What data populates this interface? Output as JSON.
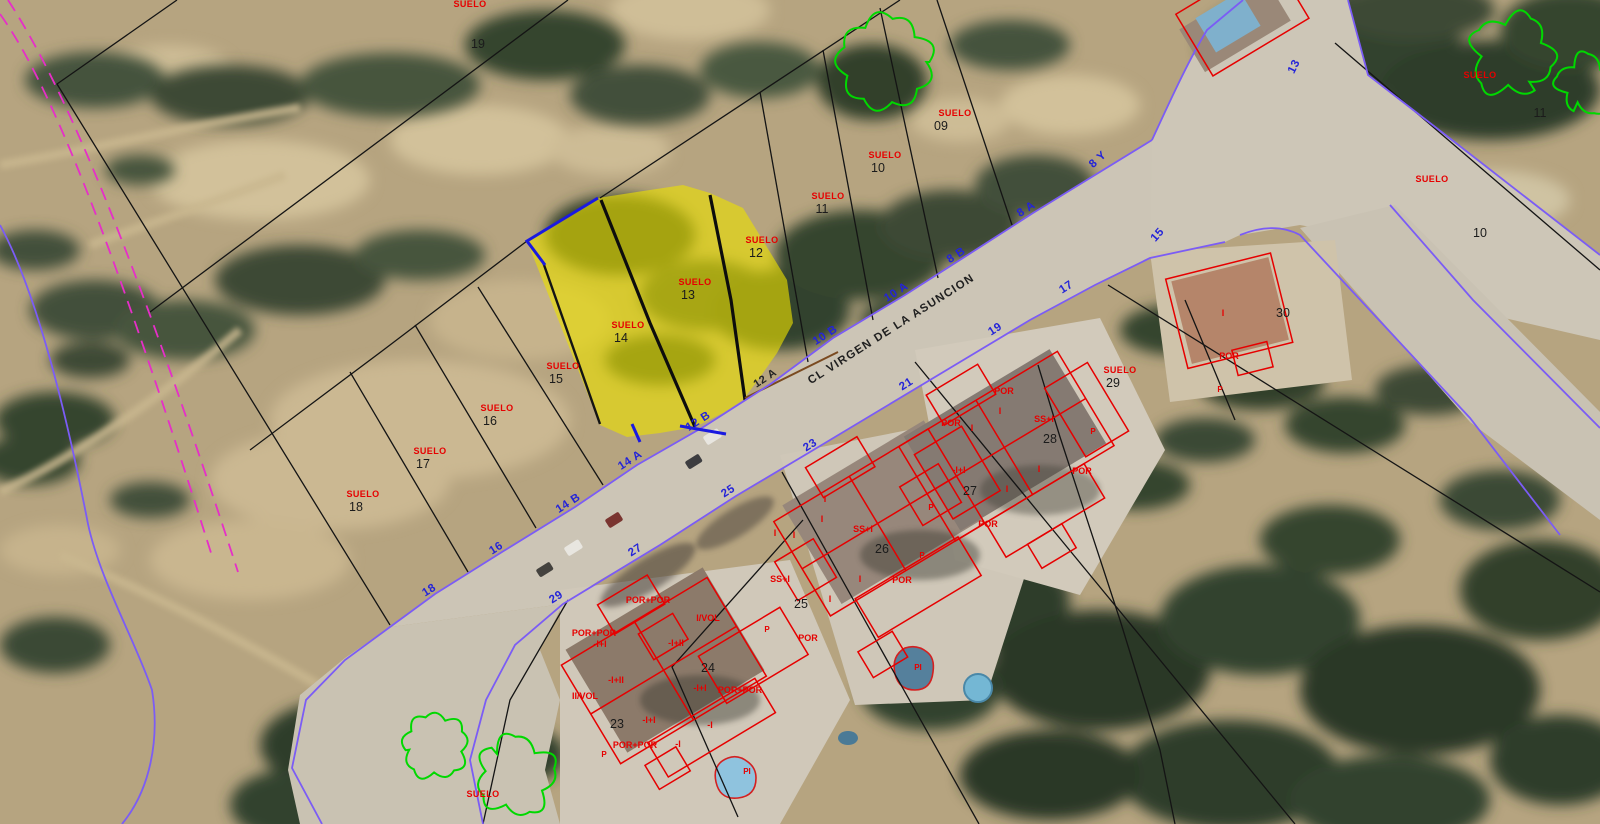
{
  "map": {
    "title": "Cadastral parcel map over aerial photo",
    "street_name": "CL VIRGEN DE LA ASUNCION",
    "selected_parcel": {
      "label": "SUELO",
      "numbers": [
        "13",
        "14"
      ],
      "frontages": [
        "12 A",
        "12 B"
      ]
    },
    "colors": {
      "parcel_line": "#141414",
      "street_line": "#7b5cf5",
      "selected_outline": "#1a1ae0",
      "highlight": "#ece000",
      "building_line": "#e60000",
      "label_red": "#e60000",
      "street_number_blue": "#2424d8",
      "tree_outline": "#00d800",
      "boundary_magenta": "#e62ec8",
      "frontage_brown": "#7a4a20"
    },
    "trees": [
      [
        885,
        62,
        46
      ],
      [
        1512,
        55,
        40
      ],
      [
        1586,
        84,
        28
      ],
      [
        435,
        746,
        32
      ],
      [
        516,
        776,
        38
      ]
    ],
    "labels": [
      {
        "t": "SUELO",
        "x": 470,
        "y": 7,
        "c": "suelo"
      },
      {
        "t": "19",
        "x": 478,
        "y": 48,
        "c": "pnum"
      },
      {
        "t": "SUELO",
        "x": 955,
        "y": 116,
        "c": "suelo"
      },
      {
        "t": "09",
        "x": 941,
        "y": 130,
        "c": "pnum"
      },
      {
        "t": "SUELO",
        "x": 885,
        "y": 158,
        "c": "suelo"
      },
      {
        "t": "10",
        "x": 878,
        "y": 172,
        "c": "pnum"
      },
      {
        "t": "SUELO",
        "x": 828,
        "y": 199,
        "c": "suelo"
      },
      {
        "t": "11",
        "x": 822,
        "y": 213,
        "c": "pnum"
      },
      {
        "t": "SUELO",
        "x": 762,
        "y": 243,
        "c": "suelo"
      },
      {
        "t": "12",
        "x": 756,
        "y": 257,
        "c": "pnum"
      },
      {
        "t": "SUELO",
        "x": 695,
        "y": 285,
        "c": "suelo"
      },
      {
        "t": "13",
        "x": 688,
        "y": 299,
        "c": "pnum"
      },
      {
        "t": "SUELO",
        "x": 628,
        "y": 328,
        "c": "suelo"
      },
      {
        "t": "14",
        "x": 621,
        "y": 342,
        "c": "pnum"
      },
      {
        "t": "SUELO",
        "x": 563,
        "y": 369,
        "c": "suelo"
      },
      {
        "t": "15",
        "x": 556,
        "y": 383,
        "c": "pnum"
      },
      {
        "t": "SUELO",
        "x": 497,
        "y": 411,
        "c": "suelo"
      },
      {
        "t": "16",
        "x": 490,
        "y": 425,
        "c": "pnum"
      },
      {
        "t": "SUELO",
        "x": 430,
        "y": 454,
        "c": "suelo"
      },
      {
        "t": "17",
        "x": 423,
        "y": 468,
        "c": "pnum"
      },
      {
        "t": "SUELO",
        "x": 363,
        "y": 497,
        "c": "suelo"
      },
      {
        "t": "18",
        "x": 356,
        "y": 511,
        "c": "pnum"
      },
      {
        "t": "SUELO",
        "x": 1480,
        "y": 78,
        "c": "suelo"
      },
      {
        "t": "11",
        "x": 1540,
        "y": 117,
        "c": "pnum"
      },
      {
        "t": "SUELO",
        "x": 1432,
        "y": 182,
        "c": "suelo"
      },
      {
        "t": "10",
        "x": 1480,
        "y": 237,
        "c": "pnum"
      },
      {
        "t": "SUELO",
        "x": 1120,
        "y": 373,
        "c": "suelo"
      },
      {
        "t": "29",
        "x": 1113,
        "y": 387,
        "c": "pnum"
      },
      {
        "t": "SUELO",
        "x": 483,
        "y": 797,
        "c": "suelo"
      },
      {
        "t": "23",
        "x": 617,
        "y": 728,
        "c": "pnum"
      },
      {
        "t": "24",
        "x": 708,
        "y": 672,
        "c": "pnum"
      },
      {
        "t": "25",
        "x": 801,
        "y": 608,
        "c": "pnum"
      },
      {
        "t": "26",
        "x": 882,
        "y": 553,
        "c": "pnum"
      },
      {
        "t": "27",
        "x": 970,
        "y": 495,
        "c": "pnum"
      },
      {
        "t": "28",
        "x": 1050,
        "y": 443,
        "c": "pnum"
      },
      {
        "t": "30",
        "x": 1283,
        "y": 317,
        "c": "pnum"
      },
      {
        "t": "8 Y",
        "x": 1100,
        "y": 162,
        "c": "snum",
        "r": -42
      },
      {
        "t": "8 A",
        "x": 1028,
        "y": 212,
        "c": "snum",
        "r": -33
      },
      {
        "t": "8 B",
        "x": 958,
        "y": 258,
        "c": "snum",
        "r": -33
      },
      {
        "t": "10 A",
        "x": 898,
        "y": 295,
        "c": "snum",
        "r": -33
      },
      {
        "t": "10 B",
        "x": 827,
        "y": 338,
        "c": "snum",
        "r": -33
      },
      {
        "t": "12 B",
        "x": 700,
        "y": 424,
        "c": "snum",
        "r": -33
      },
      {
        "t": "14 A",
        "x": 632,
        "y": 463,
        "c": "snum",
        "r": -33
      },
      {
        "t": "14 B",
        "x": 570,
        "y": 506,
        "c": "snum",
        "r": -33
      },
      {
        "t": "16",
        "x": 498,
        "y": 551,
        "c": "snum",
        "r": -33
      },
      {
        "t": "18",
        "x": 431,
        "y": 593,
        "c": "snum",
        "r": -33
      },
      {
        "t": "13",
        "x": 1297,
        "y": 68,
        "c": "snum",
        "r": -63
      },
      {
        "t": "15",
        "x": 1160,
        "y": 237,
        "c": "snum",
        "r": -48
      },
      {
        "t": "17",
        "x": 1068,
        "y": 290,
        "c": "snum",
        "r": -33
      },
      {
        "t": "19",
        "x": 997,
        "y": 332,
        "c": "snum",
        "r": -33
      },
      {
        "t": "21",
        "x": 908,
        "y": 387,
        "c": "snum",
        "r": -33
      },
      {
        "t": "23",
        "x": 812,
        "y": 448,
        "c": "snum",
        "r": -33
      },
      {
        "t": "25",
        "x": 730,
        "y": 494,
        "c": "snum",
        "r": -33
      },
      {
        "t": "27",
        "x": 637,
        "y": 553,
        "c": "snum",
        "r": -33
      },
      {
        "t": "29",
        "x": 558,
        "y": 600,
        "c": "snum",
        "r": -33
      },
      {
        "t": "12 A",
        "x": 767,
        "y": 381,
        "c": "bnum",
        "r": -33
      },
      {
        "t": "CL VIRGEN DE LA ASUNCION",
        "x": 893,
        "y": 332,
        "c": "sname",
        "r": -32.5
      },
      {
        "t": "POR+POR",
        "x": 648,
        "y": 603,
        "c": "bl"
      },
      {
        "t": "I/VOL",
        "x": 708,
        "y": 621,
        "c": "bl"
      },
      {
        "t": "POR+POR",
        "x": 594,
        "y": 636,
        "c": "bl"
      },
      {
        "t": "-I+I",
        "x": 600,
        "y": 647,
        "c": "bl"
      },
      {
        "t": "-I+II",
        "x": 676,
        "y": 646,
        "c": "bl"
      },
      {
        "t": "-I+II",
        "x": 616,
        "y": 683,
        "c": "bl"
      },
      {
        "t": "II/VOL",
        "x": 585,
        "y": 699,
        "c": "bl"
      },
      {
        "t": "-I+I",
        "x": 700,
        "y": 691,
        "c": "bl"
      },
      {
        "t": "POR+POR",
        "x": 740,
        "y": 693,
        "c": "bl"
      },
      {
        "t": "-I+I",
        "x": 649,
        "y": 723,
        "c": "bl"
      },
      {
        "t": "-I",
        "x": 710,
        "y": 728,
        "c": "bl"
      },
      {
        "t": "POR+POR",
        "x": 635,
        "y": 748,
        "c": "bl"
      },
      {
        "t": "-I",
        "x": 678,
        "y": 747,
        "c": "bl"
      },
      {
        "t": "P",
        "x": 604,
        "y": 757,
        "c": "blp"
      },
      {
        "t": "PI",
        "x": 747,
        "y": 774,
        "c": "blp"
      },
      {
        "t": "I",
        "x": 825,
        "y": 502,
        "c": "bl"
      },
      {
        "t": "I",
        "x": 822,
        "y": 522,
        "c": "bl"
      },
      {
        "t": "I",
        "x": 775,
        "y": 536,
        "c": "bl"
      },
      {
        "t": "I",
        "x": 794,
        "y": 538,
        "c": "bl"
      },
      {
        "t": "SS+I",
        "x": 863,
        "y": 532,
        "c": "bl"
      },
      {
        "t": "SS+I",
        "x": 780,
        "y": 582,
        "c": "bl"
      },
      {
        "t": "I",
        "x": 860,
        "y": 582,
        "c": "bl"
      },
      {
        "t": "POR",
        "x": 902,
        "y": 583,
        "c": "bl"
      },
      {
        "t": "I",
        "x": 830,
        "y": 602,
        "c": "bl"
      },
      {
        "t": "POR",
        "x": 808,
        "y": 641,
        "c": "bl"
      },
      {
        "t": "P",
        "x": 767,
        "y": 632,
        "c": "blp"
      },
      {
        "t": "P",
        "x": 931,
        "y": 510,
        "c": "blp"
      },
      {
        "t": "PI",
        "x": 918,
        "y": 670,
        "c": "blp"
      },
      {
        "t": "POR",
        "x": 1004,
        "y": 394,
        "c": "bl"
      },
      {
        "t": "I",
        "x": 1000,
        "y": 414,
        "c": "bl"
      },
      {
        "t": "POR",
        "x": 951,
        "y": 426,
        "c": "bl"
      },
      {
        "t": "I",
        "x": 972,
        "y": 431,
        "c": "bl"
      },
      {
        "t": "SS+I",
        "x": 1044,
        "y": 422,
        "c": "bl"
      },
      {
        "t": "-I+I",
        "x": 959,
        "y": 473,
        "c": "bl"
      },
      {
        "t": "I",
        "x": 1039,
        "y": 472,
        "c": "bl"
      },
      {
        "t": "POR",
        "x": 1082,
        "y": 474,
        "c": "bl"
      },
      {
        "t": "I",
        "x": 1007,
        "y": 492,
        "c": "bl"
      },
      {
        "t": "POR",
        "x": 988,
        "y": 527,
        "c": "bl"
      },
      {
        "t": "P",
        "x": 922,
        "y": 558,
        "c": "blp"
      },
      {
        "t": "P",
        "x": 1093,
        "y": 434,
        "c": "blp"
      },
      {
        "t": "I",
        "x": 1223,
        "y": 316,
        "c": "bl"
      },
      {
        "t": "POR",
        "x": 1229,
        "y": 359,
        "c": "bl"
      },
      {
        "t": "P",
        "x": 1220,
        "y": 392,
        "c": "blp"
      }
    ]
  }
}
